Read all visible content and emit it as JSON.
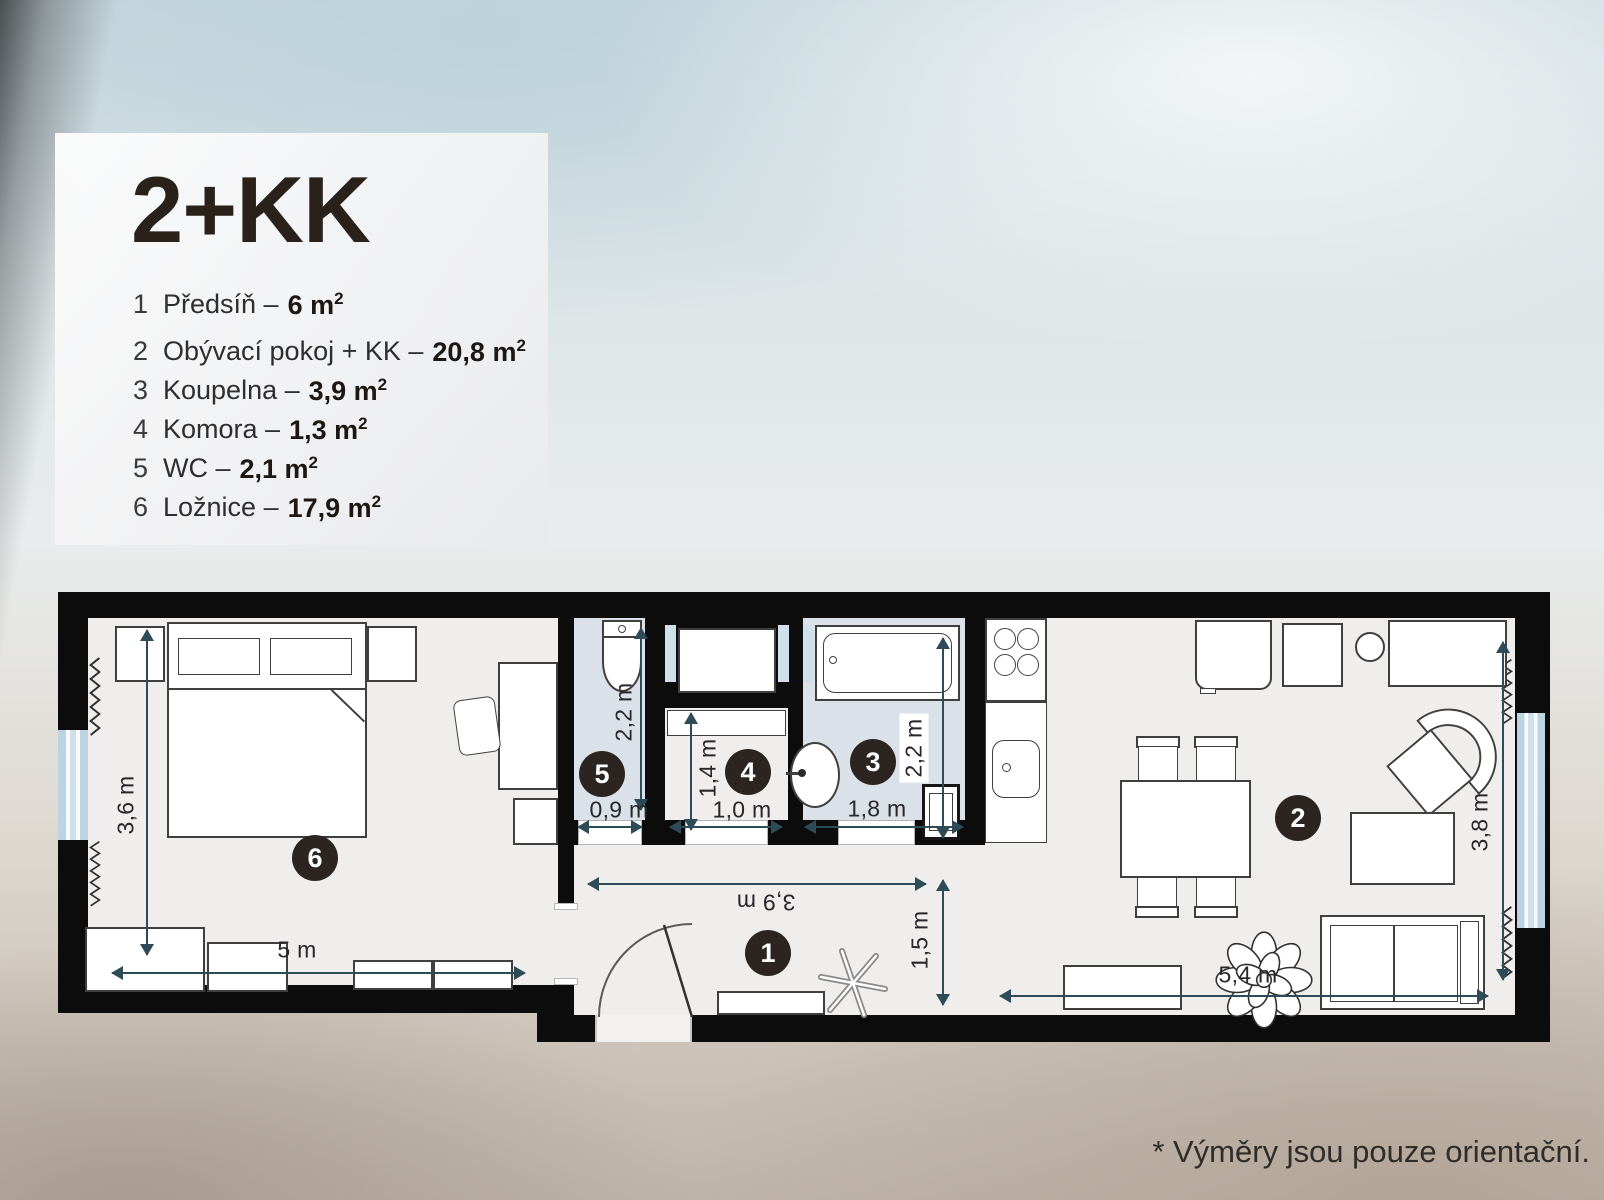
{
  "legend": {
    "title": "2+KK",
    "items": [
      {
        "num": "1",
        "name": "Předsíň –",
        "area": "6 m",
        "sup": "2"
      },
      {
        "num": "2",
        "name": "Obývací pokoj + KK –",
        "area": "20,8 m",
        "sup": "2"
      },
      {
        "num": "3",
        "name": "Koupelna –",
        "area": "3,9 m",
        "sup": "2"
      },
      {
        "num": "4",
        "name": "Komora –",
        "area": "1,3 m",
        "sup": "2"
      },
      {
        "num": "5",
        "name": "WC –",
        "area": "2,1 m",
        "sup": "2"
      },
      {
        "num": "6",
        "name": "Ložnice –",
        "area": "17,9 m",
        "sup": "2"
      }
    ]
  },
  "plan": {
    "badges": {
      "hall": "1",
      "living": "2",
      "bath": "3",
      "storage": "4",
      "wc": "5",
      "bedroom": "6"
    },
    "dims": {
      "bedroom_h": "3,6 m",
      "bedroom_w": "5 m",
      "wc_h": "2,2 m",
      "wc_w": "0,9 m",
      "storage_h": "1,4 m",
      "storage_w": "1,0 m",
      "bath_w": "1,8 m",
      "bath_h": "2,2 m",
      "hall_w": "3,9 m",
      "hall_h": "1,5 m",
      "living_w": "5,4 m",
      "living_h": "3,8 m"
    },
    "colors": {
      "wall": "#0c0c0c",
      "floor": "#efeeec",
      "wet_floor": "#dae1e8",
      "window": "#cfe0ea",
      "dimension": "#2d4c58",
      "badge": "#2c2420"
    }
  },
  "footnote": "* Výměry jsou pouze orientační."
}
